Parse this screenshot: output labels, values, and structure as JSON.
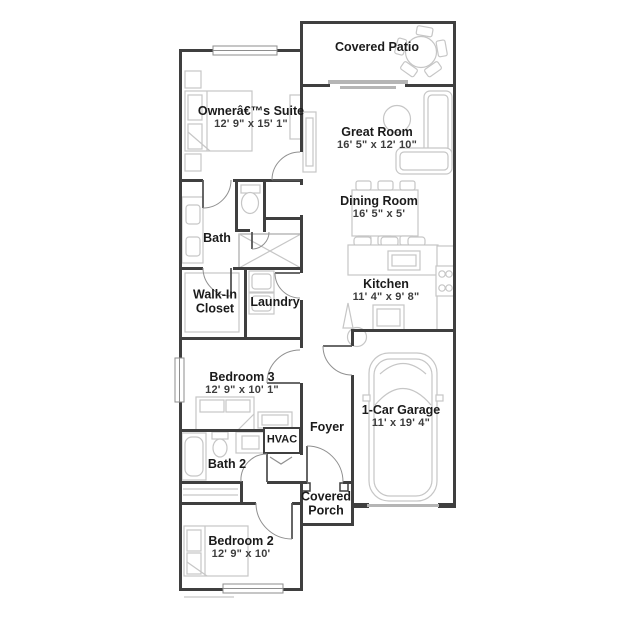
{
  "colors": {
    "wall": "#3f3f3f",
    "furniture_outline": "#c6c6c6",
    "door_arc": "#909090",
    "room_text": "#1b1b1b",
    "dim_text": "#3d3d3d",
    "background": "#ffffff"
  },
  "rooms": {
    "covered_patio": {
      "name": "Covered Patio"
    },
    "owners_suite": {
      "name": "Ownerâ€™s Suite",
      "dims": "12' 9\" x 15' 1\""
    },
    "great_room": {
      "name": "Great Room",
      "dims": "16' 5\" x 12' 10\""
    },
    "dining_room": {
      "name": "Dining Room",
      "dims": "16' 5\" x 5'"
    },
    "kitchen": {
      "name": "Kitchen",
      "dims": "11' 4\" x 9' 8\""
    },
    "bath": {
      "name": "Bath"
    },
    "walk_in_closet": {
      "name": "Walk-In Closet"
    },
    "laundry": {
      "name": "Laundry"
    },
    "bedroom_3": {
      "name": "Bedroom 3",
      "dims": "12' 9\" x 10' 1\""
    },
    "foyer": {
      "name": "Foyer"
    },
    "hvac": {
      "name": "HVAC"
    },
    "bath_2": {
      "name": "Bath 2"
    },
    "garage": {
      "name": "1-Car Garage",
      "dims": "11' x 19' 4\""
    },
    "covered_porch": {
      "name": "Covered Porch"
    },
    "bedroom_2": {
      "name": "Bedroom 2",
      "dims": "12' 9\" x 10'"
    }
  }
}
